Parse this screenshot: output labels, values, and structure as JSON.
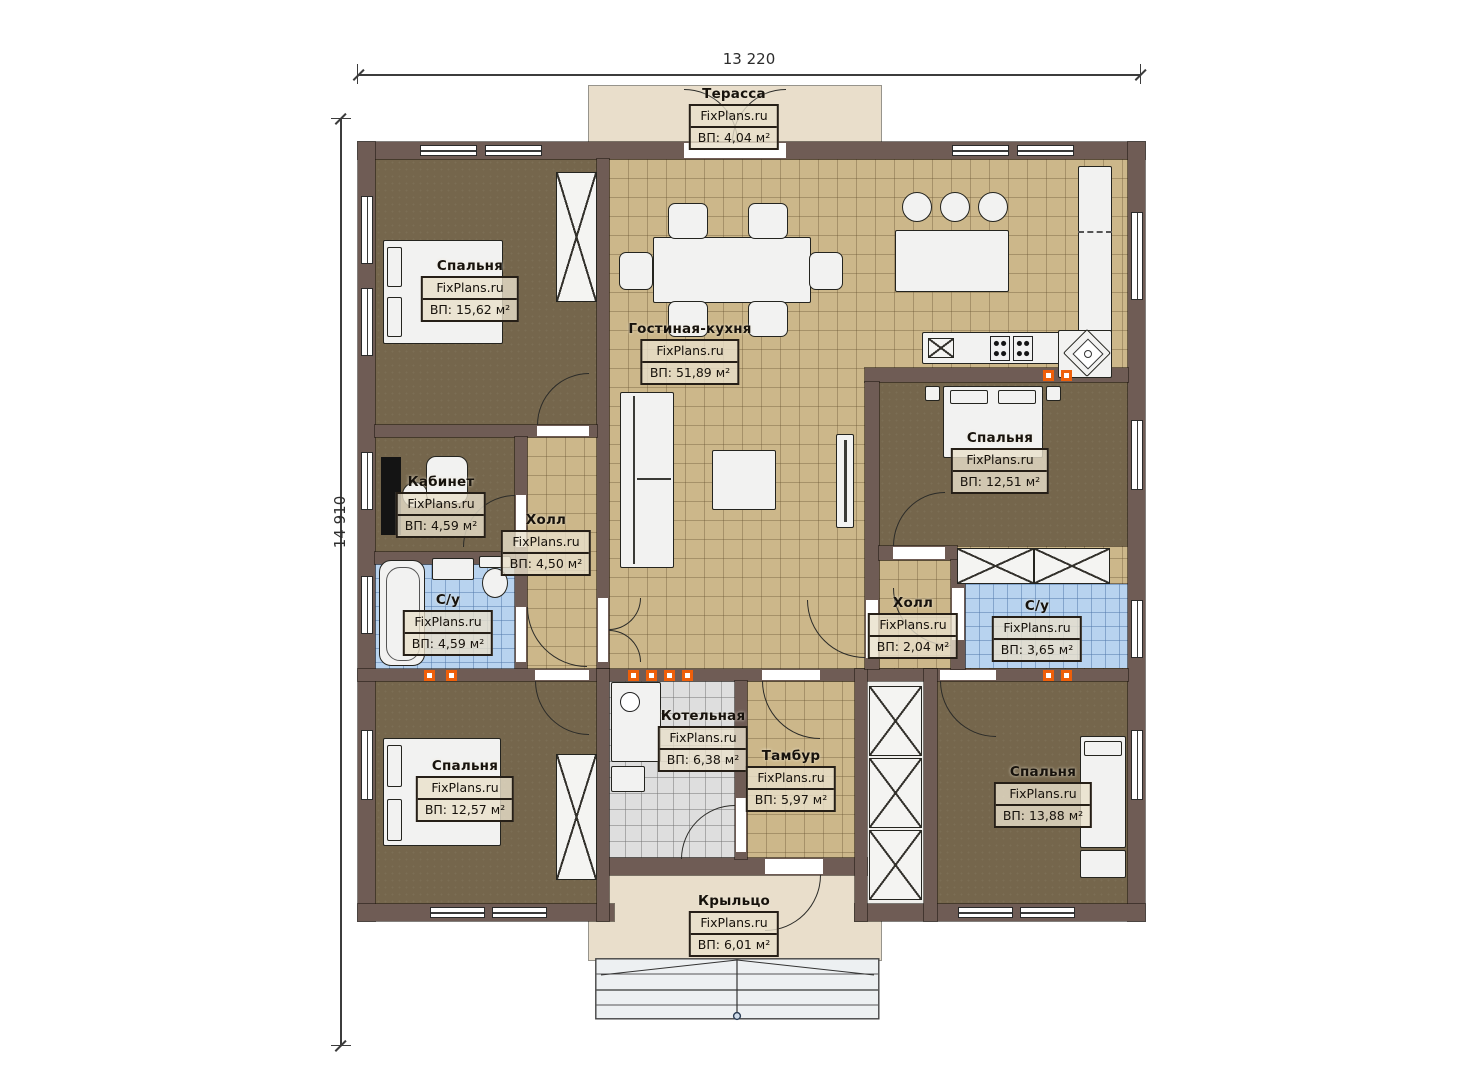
{
  "dimensions": {
    "width_label": "13 220",
    "height_label": "14 910"
  },
  "rooms": [
    {
      "id": "terrace",
      "name": "Терасса",
      "brand": "FixPlans.ru",
      "area": "ВП: 4,04 м²"
    },
    {
      "id": "bedroom-tl",
      "name": "Спальня",
      "brand": "FixPlans.ru",
      "area": "ВП: 15,62 м²"
    },
    {
      "id": "living-kitchen",
      "name": "Гостиная-кухня",
      "brand": "FixPlans.ru",
      "area": "ВП: 51,89 м²"
    },
    {
      "id": "study",
      "name": "Кабинет",
      "brand": "FixPlans.ru",
      "area": "ВП: 4,59 м²"
    },
    {
      "id": "hall-left",
      "name": "Холл",
      "brand": "FixPlans.ru",
      "area": "ВП: 4,50 м²"
    },
    {
      "id": "bath-left",
      "name": "С/у",
      "brand": "FixPlans.ru",
      "area": "ВП: 4,59 м²"
    },
    {
      "id": "bedroom-right",
      "name": "Спальня",
      "brand": "FixPlans.ru",
      "area": "ВП: 12,51 м²"
    },
    {
      "id": "hall-right",
      "name": "Холл",
      "brand": "FixPlans.ru",
      "area": "ВП: 2,04 м²"
    },
    {
      "id": "bath-right",
      "name": "С/у",
      "brand": "FixPlans.ru",
      "area": "ВП: 3,65 м²"
    },
    {
      "id": "bedroom-bl",
      "name": "Спальня",
      "brand": "FixPlans.ru",
      "area": "ВП: 12,57 м²"
    },
    {
      "id": "boiler-room",
      "name": "Котельная",
      "brand": "FixPlans.ru",
      "area": "ВП: 6,38 м²"
    },
    {
      "id": "vestibule",
      "name": "Тамбур",
      "brand": "FixPlans.ru",
      "area": "ВП: 5,97 м²"
    },
    {
      "id": "bedroom-br",
      "name": "Спальня",
      "brand": "FixPlans.ru",
      "area": "ВП: 13,88 м²"
    },
    {
      "id": "porch",
      "name": "Крыльцо",
      "brand": "FixPlans.ru",
      "area": "ВП: 6,01 м²"
    }
  ],
  "colors": {
    "wall": "#6f5c55",
    "floor_dark": "#75664c",
    "tile_sand": "#ccb78a",
    "tile_blue": "#b8d3ef",
    "tile_gray": "#dedede",
    "deck": "#e9decb",
    "vent": "#ee5f0a"
  }
}
